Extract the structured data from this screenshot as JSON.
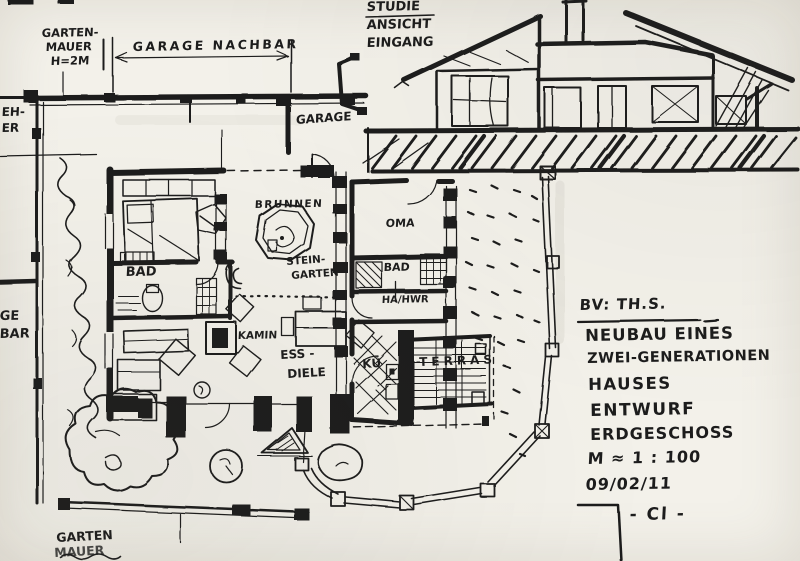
{
  "colors": {
    "paper": "#f3f1ea",
    "ink": "#1d1d1d"
  },
  "annotations": {
    "garten_mauer_top": {
      "line1": "GARTEN-",
      "line2": "MAUER",
      "line3": "H=2M"
    },
    "garage_nachbar": "GARAGE NACHBAR",
    "studie": {
      "line1": "STUDIE",
      "line2": "ANSICHT",
      "line3": "EINGANG"
    },
    "left_edge_top": {
      "line1": "EH-",
      "line2": "ER"
    },
    "left_edge_mid": {
      "line1": "GE",
      "line2": "BAR"
    },
    "garage": "GARAGE",
    "garten_mauer_bottom": {
      "line1": "GARTEN",
      "line2": "MAUER"
    }
  },
  "rooms": {
    "brunnen": "BRUNNEN",
    "steingarten_line1": "STEIN-",
    "steingarten_line2": "GARTEN",
    "oma": "OMA",
    "bad_left": "BAD",
    "bad_right": "BAD",
    "ha_hwr": "HA/HWR",
    "kamin": "KAMIN",
    "ess_line1": "ESS -",
    "ess_line2": "DIELE",
    "kueche": "KÜ",
    "terrasse": "TERRAS"
  },
  "title_block": {
    "project": "BV: TH.S.",
    "line1": "NEUBAU EINES",
    "line2": "ZWEI-GENERATIONEN",
    "line3": "HAUSES",
    "line4": "ENTWURF",
    "line5": "ERDGESCHOSS",
    "scale": "M ≈ 1 : 100",
    "date": "09/02/11",
    "signature": "- Cl -"
  }
}
